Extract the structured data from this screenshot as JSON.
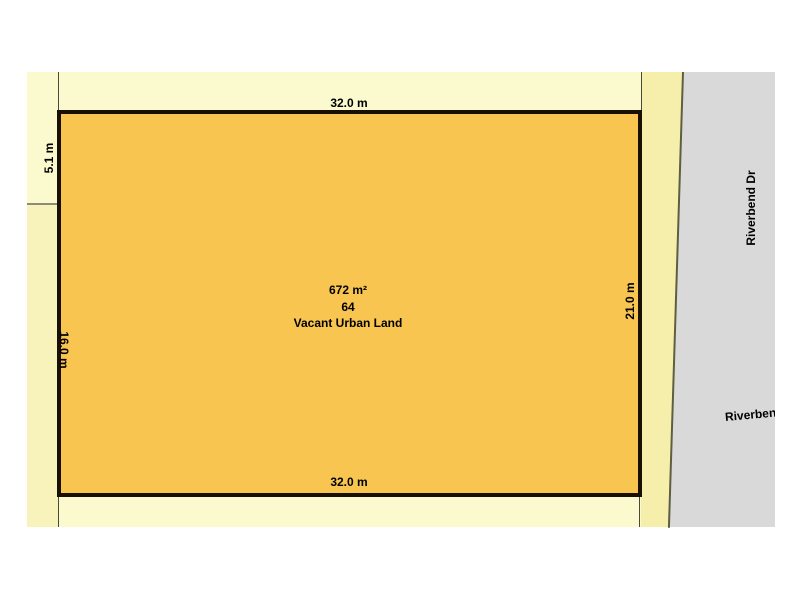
{
  "parcel": {
    "area": "672 m²",
    "lot_number": "64",
    "land_use": "Vacant Urban Land"
  },
  "dimensions": {
    "top": "32.0 m",
    "bottom": "32.0 m",
    "right": "21.0 m",
    "left_upper": "5.1 m",
    "left_lower": "16.0 m"
  },
  "road": {
    "name": "Riverbend Dr",
    "name_clipped": "Riverbend"
  },
  "colors": {
    "background": "#ffffff",
    "lot_light": "#fbf9ce",
    "lot_mid": "#f8f3bb",
    "lot_deep": "#f6efac",
    "parcel_fill": "#f8c551",
    "parcel_border": "#190f02",
    "road_fill": "#d9d9d9",
    "road_edge": "#5e5e40",
    "boundary_line": "#4a4a38",
    "divider_line": "#8c8c78",
    "label_color": "#000000"
  }
}
